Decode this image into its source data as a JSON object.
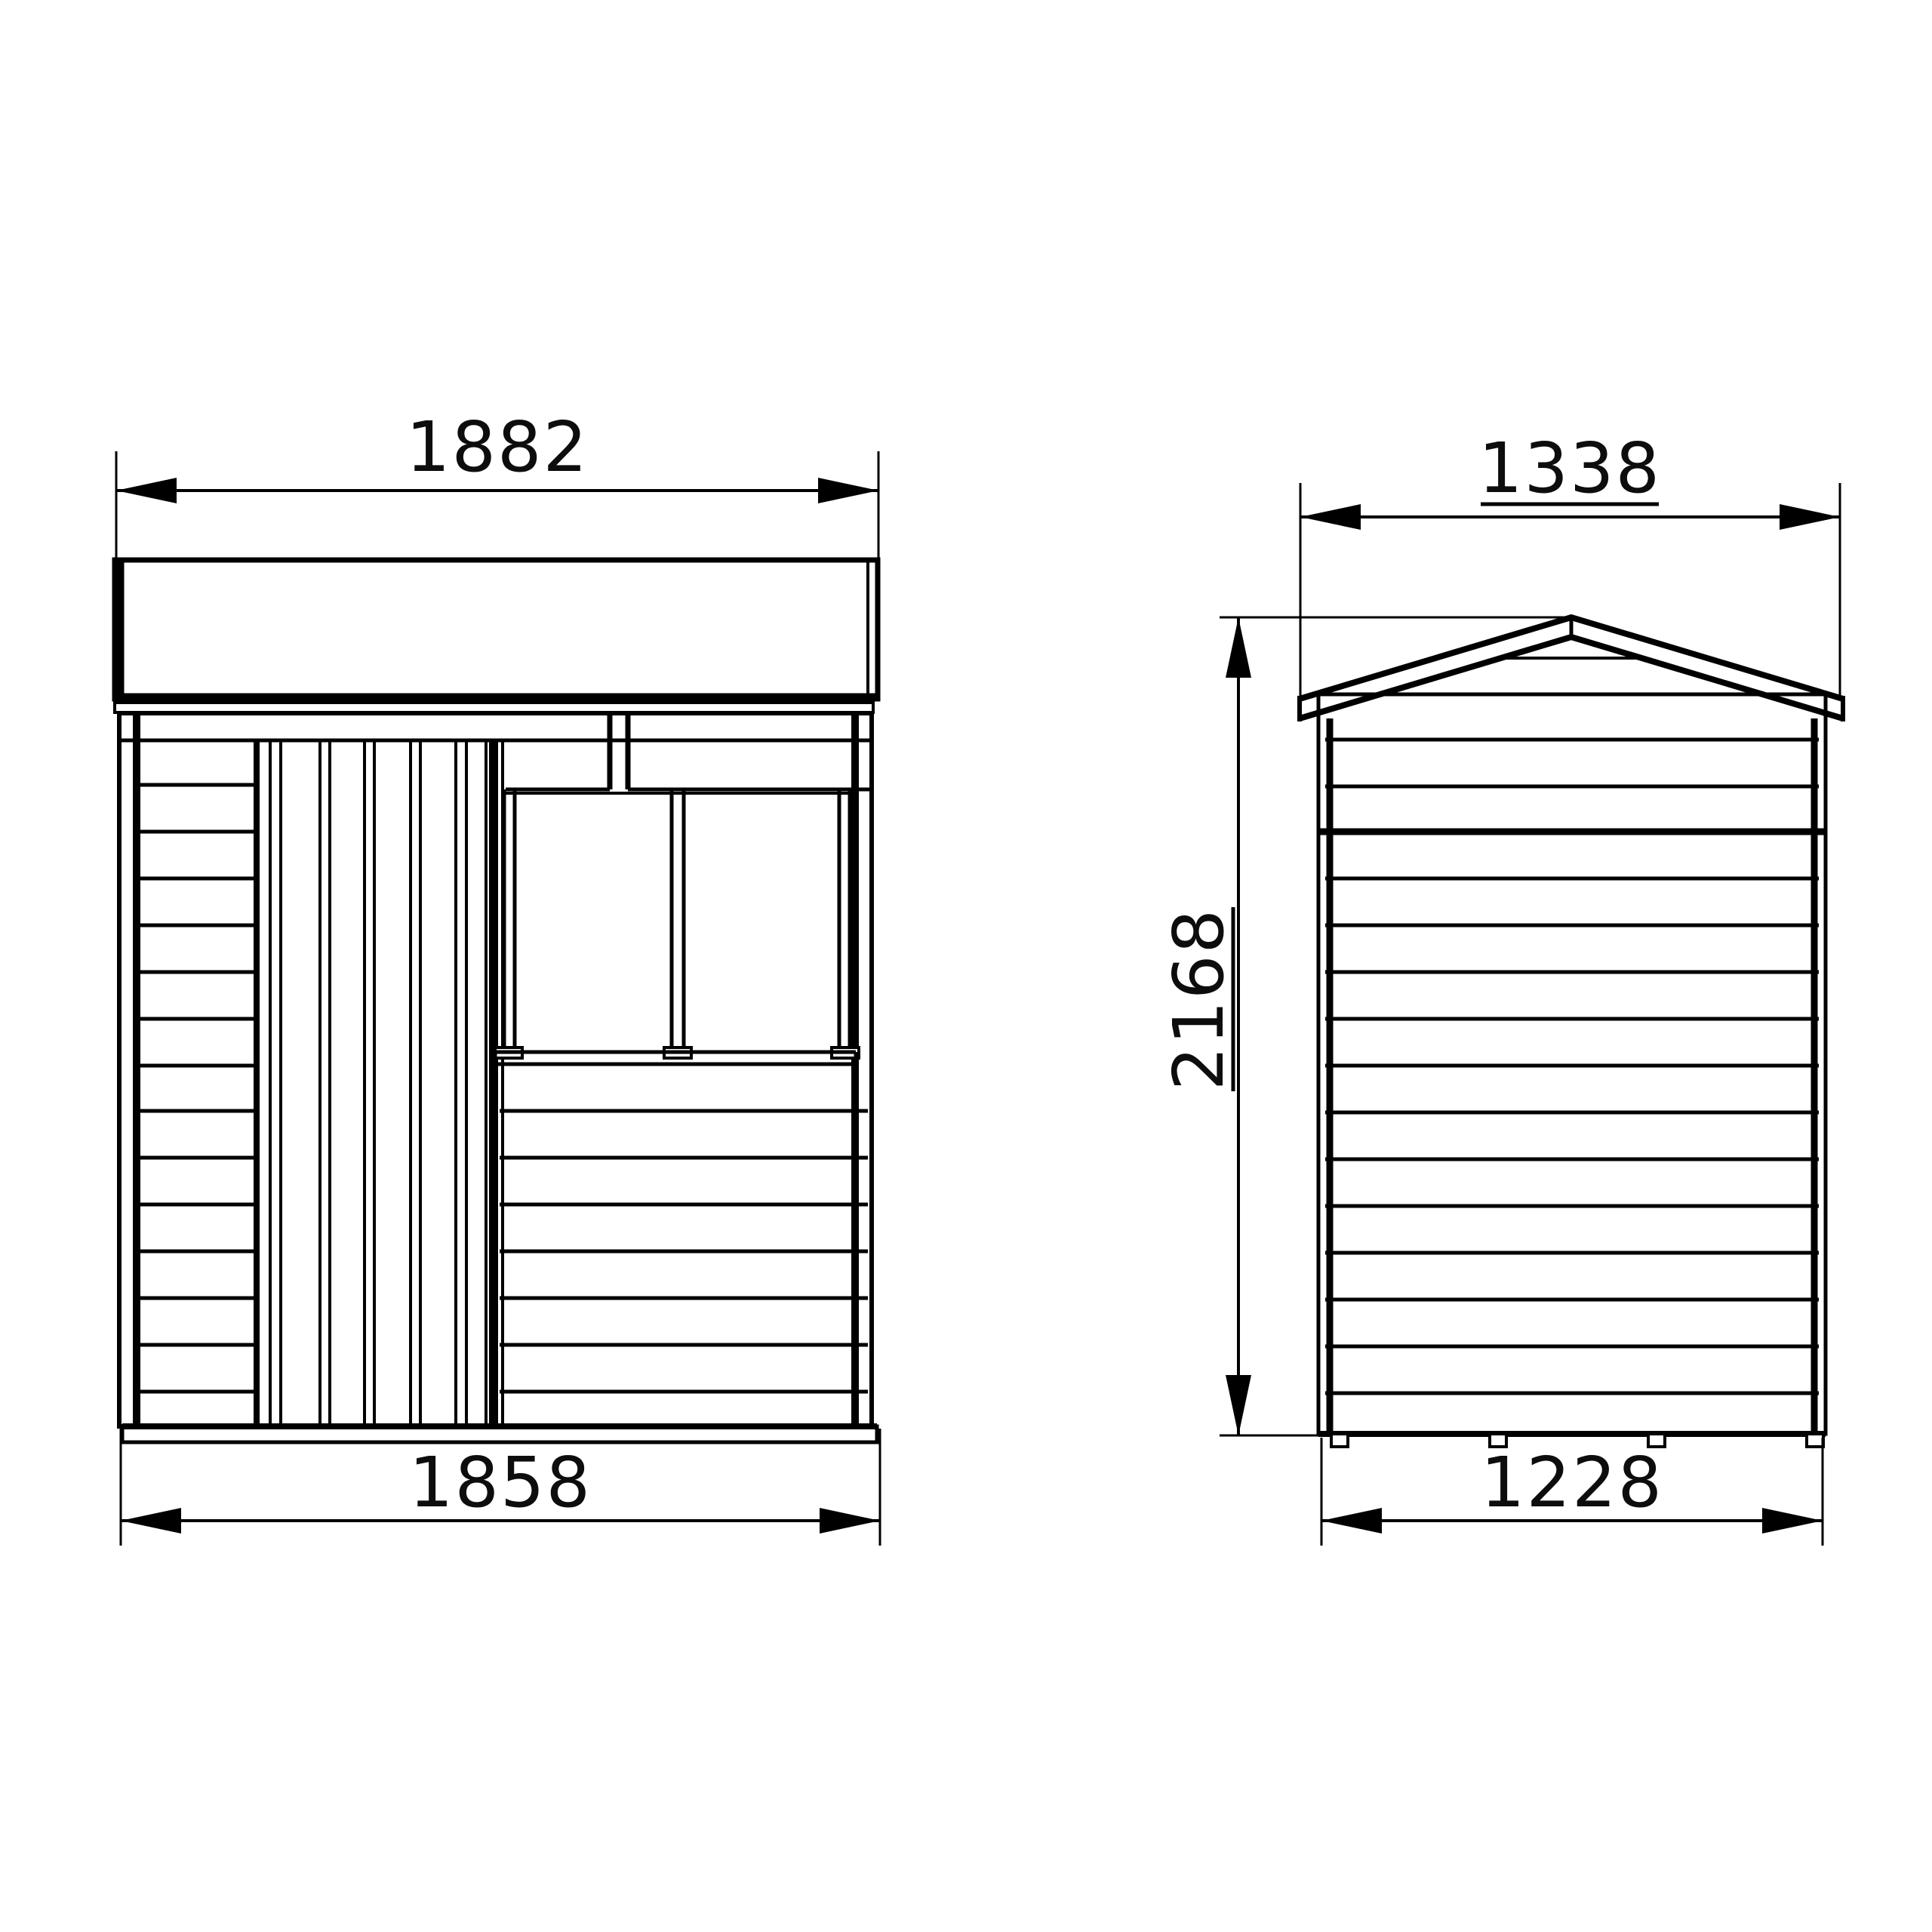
{
  "drawing": {
    "type": "technical-elevation-drawing",
    "subject": "garden shed with apex roof, plank door and two-pane window",
    "background_color": "#ffffff",
    "line_color": "#000000",
    "views": {
      "front": {
        "label": "front elevation",
        "dimensions": {
          "top_width": "1882",
          "bottom_width": "1858"
        }
      },
      "side": {
        "label": "side elevation",
        "dimensions": {
          "top_width": "1338",
          "height": "2168",
          "bottom_width": "1228"
        }
      }
    }
  }
}
